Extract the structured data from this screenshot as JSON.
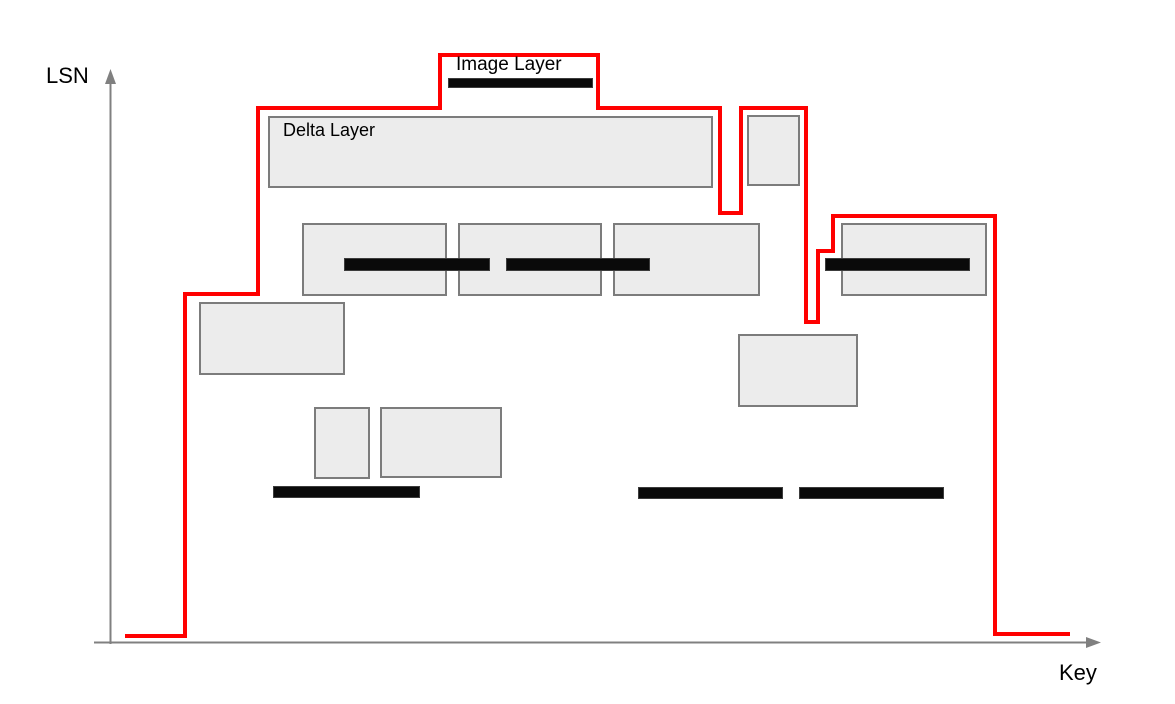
{
  "labels": {
    "y_axis": "LSN",
    "x_axis": "Key",
    "image_layer": "Image Layer",
    "delta_layer": "Delta Layer"
  },
  "colors": {
    "boundary_line": "#ff0000",
    "rect_fill": "#ececec",
    "rect_border": "#7c7c7c",
    "bar_fill": "#0a0a0a",
    "bar_border": "#3c3c3c",
    "axis": "#808080",
    "text": "#000000"
  },
  "diagram": {
    "axes": {
      "y": {
        "x": 110.5,
        "y1": 80,
        "y2": 644,
        "arrow": "110.5,69 105,84 116,84"
      },
      "x": {
        "y": 642.5,
        "x1": 94,
        "x2": 1087,
        "arrow": "1101,642.5 1086,637 1086,648"
      }
    },
    "boundary_points": [
      [
        125,
        636
      ],
      [
        185,
        636
      ],
      [
        185,
        294
      ],
      [
        258,
        294
      ],
      [
        258,
        108
      ],
      [
        440,
        108
      ],
      [
        440,
        55
      ],
      [
        598,
        55
      ],
      [
        598,
        108
      ],
      [
        720,
        108
      ],
      [
        720,
        213
      ],
      [
        741,
        213
      ],
      [
        741,
        108
      ],
      [
        806,
        108
      ],
      [
        806,
        322
      ],
      [
        818,
        322
      ],
      [
        818,
        251
      ],
      [
        833,
        251
      ],
      [
        833,
        216
      ],
      [
        995,
        216
      ],
      [
        995,
        634
      ],
      [
        1070,
        634
      ]
    ],
    "delta_rects": [
      {
        "name": "delta-layer-rect-labeled",
        "x": 268,
        "y": 116,
        "w": 445,
        "h": 72
      },
      {
        "name": "delta-layer-rect-small-top",
        "x": 747,
        "y": 115,
        "w": 53,
        "h": 71
      },
      {
        "name": "delta-layer-rect-mid-1",
        "x": 302,
        "y": 223,
        "w": 145,
        "h": 73
      },
      {
        "name": "delta-layer-rect-mid-2",
        "x": 458,
        "y": 223,
        "w": 144,
        "h": 73
      },
      {
        "name": "delta-layer-rect-mid-3",
        "x": 613,
        "y": 223,
        "w": 147,
        "h": 73
      },
      {
        "name": "delta-layer-rect-right",
        "x": 841,
        "y": 223,
        "w": 146,
        "h": 73
      },
      {
        "name": "delta-layer-rect-left",
        "x": 199,
        "y": 302,
        "w": 146,
        "h": 73
      },
      {
        "name": "delta-layer-rect-lower-right",
        "x": 738,
        "y": 334,
        "w": 120,
        "h": 73
      },
      {
        "name": "delta-layer-rect-small-bottom",
        "x": 314,
        "y": 407,
        "w": 56,
        "h": 72
      },
      {
        "name": "delta-layer-rect-bottom",
        "x": 380,
        "y": 407,
        "w": 122,
        "h": 71
      }
    ],
    "image_bars": [
      {
        "name": "image-layer-bar-labeled",
        "x": 448,
        "y": 78,
        "w": 145,
        "h": 10
      },
      {
        "name": "image-layer-bar-mid-1",
        "x": 344,
        "y": 258,
        "w": 146,
        "h": 13
      },
      {
        "name": "image-layer-bar-mid-2",
        "x": 506,
        "y": 258,
        "w": 144,
        "h": 13
      },
      {
        "name": "image-layer-bar-right",
        "x": 825,
        "y": 258,
        "w": 145,
        "h": 13
      },
      {
        "name": "image-layer-bar-bottom-1",
        "x": 273,
        "y": 486,
        "w": 147,
        "h": 12
      },
      {
        "name": "image-layer-bar-bottom-2",
        "x": 638,
        "y": 487,
        "w": 145,
        "h": 12
      },
      {
        "name": "image-layer-bar-bottom-3",
        "x": 799,
        "y": 487,
        "w": 145,
        "h": 12
      }
    ]
  }
}
